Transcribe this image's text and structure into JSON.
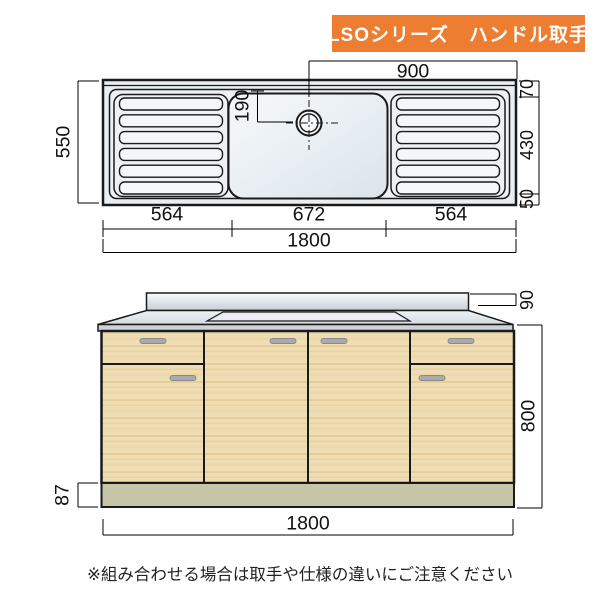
{
  "banner": {
    "label": "LSOシリーズ　ハンドル取手",
    "bg_color": "#ed7d31",
    "text_color": "#ffffff"
  },
  "top_view": {
    "description": "sink top view with two drainboards, center bowl and faucet hole",
    "dims": {
      "faucet_offset_right": "900",
      "faucet_offset_top": "190",
      "total_depth": "550",
      "right_top": "70",
      "right_middle": "430",
      "right_bottom": "50",
      "seg_left": "564",
      "seg_center": "672",
      "seg_right": "564",
      "total_width": "1800"
    }
  },
  "front_view": {
    "description": "base cabinet front view with two drawers, four doors and kickplate",
    "dims": {
      "backsplash_height": "90",
      "body_height": "800",
      "kickplate_height": "87",
      "total_width": "1800"
    }
  },
  "note": "※組み合わせる場合は取手や仕様の違いにご注意ください",
  "colors": {
    "banner": "#ed7d31",
    "wood": "#efddb4",
    "kickplate": "#c7c5a8",
    "counter": "#dfe6ec",
    "handle": "#aaaaaa",
    "line": "#1a1a1a"
  }
}
